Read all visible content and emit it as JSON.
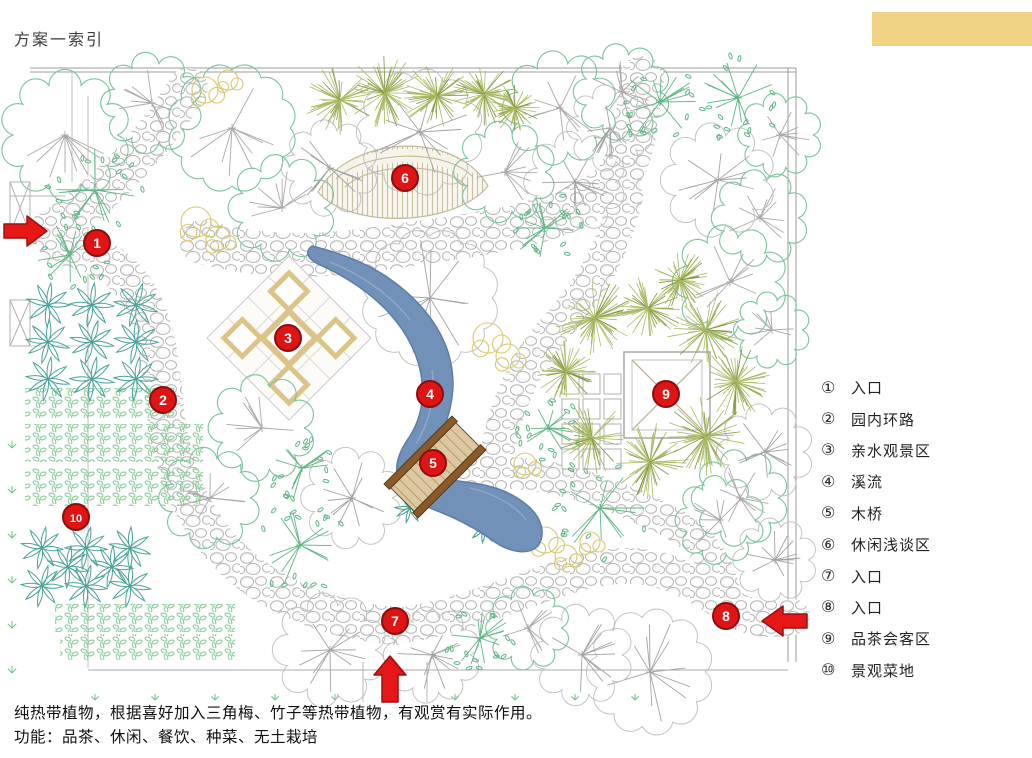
{
  "page": {
    "title": "方案一索引"
  },
  "accent_bar": {
    "color": "#F0D285"
  },
  "legend": {
    "items": [
      {
        "num": "①",
        "label": "入口"
      },
      {
        "num": "②",
        "label": "园内环路"
      },
      {
        "num": "③",
        "label": "亲水观景区"
      },
      {
        "num": "④",
        "label": "溪流"
      },
      {
        "num": "⑤",
        "label": "木桥"
      },
      {
        "num": "⑥",
        "label": "休闲浅谈区"
      },
      {
        "num": "⑦",
        "label": "入口"
      },
      {
        "num": "⑧",
        "label": "入口"
      },
      {
        "num": "⑨",
        "label": "品茶会客区"
      },
      {
        "num": "⑩",
        "label": "景观菜地"
      }
    ]
  },
  "plan": {
    "marker_color": "#DF1414",
    "stream_color": "#7191B8",
    "arrow_color": "#E51717",
    "markers": [
      {
        "num": "1",
        "x": 97,
        "y": 243
      },
      {
        "num": "2",
        "x": 163,
        "y": 400
      },
      {
        "num": "3",
        "x": 288,
        "y": 338
      },
      {
        "num": "4",
        "x": 430,
        "y": 394
      },
      {
        "num": "5",
        "x": 433,
        "y": 463
      },
      {
        "num": "6",
        "x": 405,
        "y": 178
      },
      {
        "num": "7",
        "x": 395,
        "y": 621
      },
      {
        "num": "8",
        "x": 726,
        "y": 616
      },
      {
        "num": "9",
        "x": 666,
        "y": 394
      },
      {
        "num": "10",
        "x": 76,
        "y": 517
      }
    ]
  },
  "notes": {
    "line1": "纯热带植物，根据喜好加入三角梅、竹子等热带植物，有观赏有实际作用。",
    "line2": "功能：品茶、休闲、餐饮、种菜、无土栽培"
  }
}
